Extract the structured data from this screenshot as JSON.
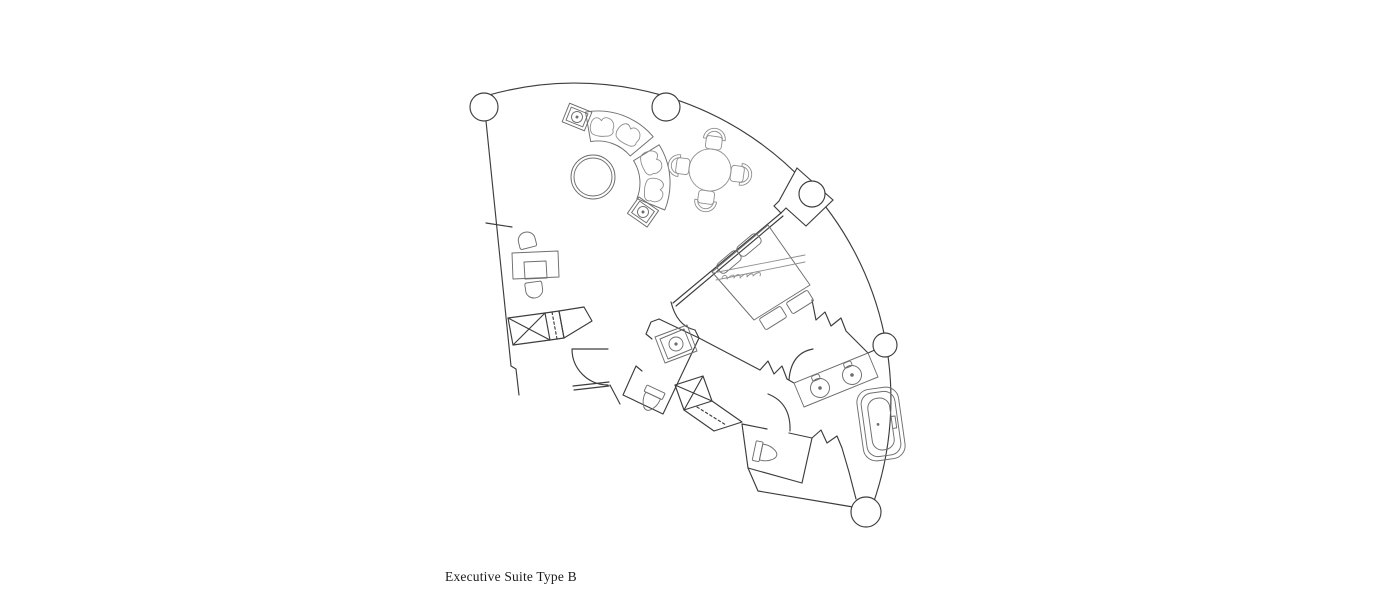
{
  "page": {
    "width": 1400,
    "height": 595,
    "background": "#ffffff"
  },
  "caption": {
    "text": "Executive Suite Type B"
  },
  "colors": {
    "wall_line": "#3d3d3d",
    "furniture_line": "#6e6e6e",
    "light_line": "#8f8f8f",
    "background": "#ffffff",
    "text_color": "#1c1c1c"
  },
  "plan": {
    "type": "hotel suite floor plan",
    "shape": "curved fan-shaped suite (segment of circular tower)",
    "columns_count": 5,
    "rooms": [
      {
        "name": "living-dining-area"
      },
      {
        "name": "bedroom"
      },
      {
        "name": "entry-hall"
      },
      {
        "name": "powder-room"
      },
      {
        "name": "wc"
      },
      {
        "name": "bathroom"
      }
    ],
    "furniture": [
      {
        "name": "curved-sofa",
        "seats": 4
      },
      {
        "name": "round-coffee-table"
      },
      {
        "name": "side-table-with-lamp",
        "count": 2
      },
      {
        "name": "round-dining-table",
        "chairs": 4
      },
      {
        "name": "writing-desk",
        "chairs": 2
      },
      {
        "name": "entry-wardrobe"
      },
      {
        "name": "king-bed",
        "pillows": 2
      },
      {
        "name": "foot-bench",
        "cushions": 2
      },
      {
        "name": "closet-with-rail"
      },
      {
        "name": "double-vanity",
        "sinks": 2
      },
      {
        "name": "bathtub"
      },
      {
        "name": "toilet",
        "count": 2
      },
      {
        "name": "powder-sink"
      }
    ]
  }
}
